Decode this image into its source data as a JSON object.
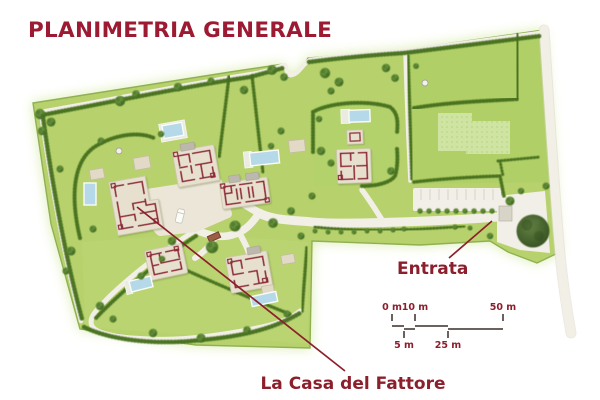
{
  "title": "PLANIMETRIA GENERALE",
  "map_labels": {
    "entrance": "Entrata",
    "farmhouse": "La Casa del Fattore"
  },
  "scale_bar": {
    "top_labels": [
      "0 m",
      "10 m",
      "50 m"
    ],
    "bottom_labels": [
      "5 m",
      "25 m"
    ]
  },
  "features": {
    "villas_count": 6,
    "pools_count": 6,
    "entrance_tree": "large-tree-icon",
    "parking_area": "parking-stalls"
  },
  "colors": {
    "title_red": "#9c1b33",
    "label_red": "#8c1f2c",
    "land_green": "#b7d26d",
    "hedge_green": "#456e1e",
    "path_white": "#f2efe7",
    "building_wall_red": "#8e2b38",
    "building_base_beige": "#e7e0ce",
    "pool_blue": "#b6d9e9"
  }
}
